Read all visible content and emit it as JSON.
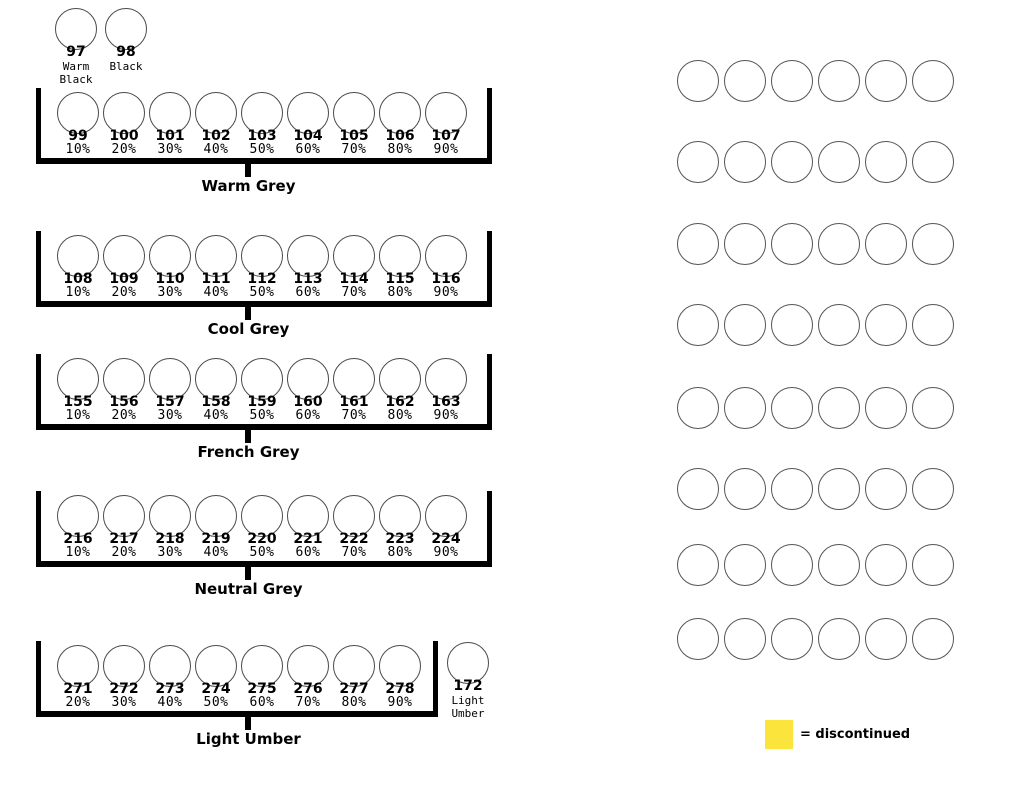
{
  "loose_swatches": [
    {
      "number": "97",
      "name_lines": [
        "Warm",
        "Black"
      ]
    },
    {
      "number": "98",
      "name_lines": [
        "Black"
      ]
    }
  ],
  "groups": [
    {
      "label": "Warm Grey",
      "swatches": [
        {
          "number": "99",
          "percent": "10%"
        },
        {
          "number": "100",
          "percent": "20%"
        },
        {
          "number": "101",
          "percent": "30%"
        },
        {
          "number": "102",
          "percent": "40%"
        },
        {
          "number": "103",
          "percent": "50%"
        },
        {
          "number": "104",
          "percent": "60%"
        },
        {
          "number": "105",
          "percent": "70%"
        },
        {
          "number": "106",
          "percent": "80%"
        },
        {
          "number": "107",
          "percent": "90%"
        }
      ]
    },
    {
      "label": "Cool Grey",
      "swatches": [
        {
          "number": "108",
          "percent": "10%"
        },
        {
          "number": "109",
          "percent": "20%"
        },
        {
          "number": "110",
          "percent": "30%"
        },
        {
          "number": "111",
          "percent": "40%"
        },
        {
          "number": "112",
          "percent": "50%"
        },
        {
          "number": "113",
          "percent": "60%"
        },
        {
          "number": "114",
          "percent": "70%"
        },
        {
          "number": "115",
          "percent": "80%"
        },
        {
          "number": "116",
          "percent": "90%"
        }
      ]
    },
    {
      "label": "French Grey",
      "swatches": [
        {
          "number": "155",
          "percent": "10%"
        },
        {
          "number": "156",
          "percent": "20%"
        },
        {
          "number": "157",
          "percent": "30%"
        },
        {
          "number": "158",
          "percent": "40%"
        },
        {
          "number": "159",
          "percent": "50%"
        },
        {
          "number": "160",
          "percent": "60%"
        },
        {
          "number": "161",
          "percent": "70%"
        },
        {
          "number": "162",
          "percent": "80%"
        },
        {
          "number": "163",
          "percent": "90%"
        }
      ]
    },
    {
      "label": "Neutral Grey",
      "swatches": [
        {
          "number": "216",
          "percent": "10%"
        },
        {
          "number": "217",
          "percent": "20%"
        },
        {
          "number": "218",
          "percent": "30%"
        },
        {
          "number": "219",
          "percent": "40%"
        },
        {
          "number": "220",
          "percent": "50%"
        },
        {
          "number": "221",
          "percent": "60%"
        },
        {
          "number": "222",
          "percent": "70%"
        },
        {
          "number": "223",
          "percent": "80%"
        },
        {
          "number": "224",
          "percent": "90%"
        }
      ]
    },
    {
      "label": "Light Umber",
      "swatches": [
        {
          "number": "271",
          "percent": "20%"
        },
        {
          "number": "272",
          "percent": "30%"
        },
        {
          "number": "273",
          "percent": "40%"
        },
        {
          "number": "274",
          "percent": "50%"
        },
        {
          "number": "275",
          "percent": "60%"
        },
        {
          "number": "276",
          "percent": "70%"
        },
        {
          "number": "277",
          "percent": "80%"
        },
        {
          "number": "278",
          "percent": "90%"
        }
      ],
      "extra_swatch": {
        "number": "172",
        "name_lines": [
          "Light",
          "Umber"
        ]
      }
    }
  ],
  "blank_grid": {
    "rows": 8,
    "cols": 6
  },
  "legend": {
    "swatch_color": "#FBE43C",
    "text": "= discontinued"
  }
}
